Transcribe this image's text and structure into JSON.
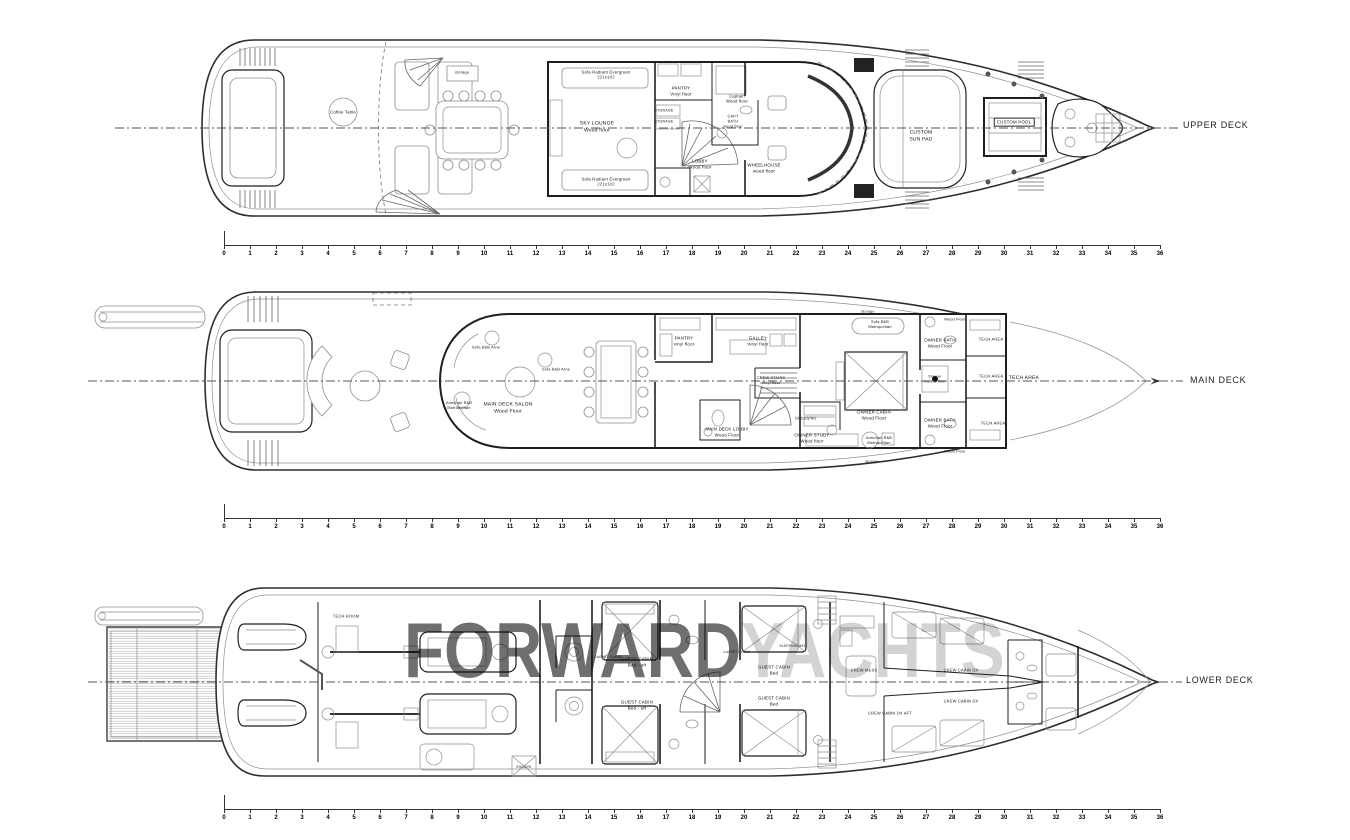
{
  "watermark": {
    "primary": "FORWARD",
    "secondary": "YACHTS"
  },
  "rulers": {
    "min": 0,
    "max": 36,
    "x": 224,
    "width": 936,
    "ys": [
      245,
      518,
      809
    ]
  },
  "decks": [
    {
      "name": "UPPER DECK",
      "label_x": 1183,
      "label_y": 125,
      "rooms": [
        {
          "t": "Coffee Table",
          "x": 343,
          "y": 112,
          "fs": 4.2
        },
        {
          "t": "storage",
          "x": 462,
          "y": 73,
          "fs": 3.8
        },
        {
          "t": "Sofa Radiant Evergreen\n221x102",
          "x": 606,
          "y": 75,
          "fs": 4.2
        },
        {
          "t": "SKY LOUNGE\nWood floor",
          "x": 597,
          "y": 127,
          "fs": 5
        },
        {
          "t": "Sofa Radiant Evergreen\n221x102",
          "x": 606,
          "y": 182,
          "fs": 4.2
        },
        {
          "t": "PANTRY\nVinyl floor",
          "x": 681,
          "y": 91,
          "fs": 4.4
        },
        {
          "t": "STORAGE",
          "x": 664,
          "y": 111,
          "fs": 3.6
        },
        {
          "t": "STORAGE",
          "x": 664,
          "y": 122,
          "fs": 3.6
        },
        {
          "t": "Captain\nWood floor",
          "x": 737,
          "y": 99,
          "fs": 4.2
        },
        {
          "t": "CAPT\nBATH\nwood floor",
          "x": 733,
          "y": 122,
          "fs": 3.8
        },
        {
          "t": "LOBBY\nWood floor",
          "x": 700,
          "y": 164,
          "fs": 4.4
        },
        {
          "t": "WHEELHOUSE\nwood floor",
          "x": 764,
          "y": 168,
          "fs": 4.4
        },
        {
          "t": "CUSTOM\nSUN PAD",
          "x": 921,
          "y": 136,
          "fs": 5
        },
        {
          "t": "CUSTOM POOL",
          "x": 1014,
          "y": 122,
          "fs": 4.4,
          "box": true
        }
      ]
    },
    {
      "name": "MAIN DECK",
      "label_x": 1190,
      "label_y": 380,
      "rooms": [
        {
          "t": "Armchair B&B\nMetropolitan",
          "x": 459,
          "y": 406,
          "fs": 3.8
        },
        {
          "t": "Sofa B&B Arne",
          "x": 486,
          "y": 348,
          "fs": 3.8
        },
        {
          "t": "Sofa B&B Arne",
          "x": 556,
          "y": 370,
          "fs": 3.8
        },
        {
          "t": "MAIN DECK SALON\nWood Floor",
          "x": 508,
          "y": 408,
          "fs": 5
        },
        {
          "t": "PANTRY\nvinyl floor",
          "x": 684,
          "y": 341,
          "fs": 4.4
        },
        {
          "t": "GALLEY\nVinyl floor",
          "x": 758,
          "y": 341,
          "fs": 4.4
        },
        {
          "t": "CREW STAIRS\nVinyl floor",
          "x": 771,
          "y": 381,
          "fs": 3.8
        },
        {
          "t": "MAIN DECK LOBBY\nWood Floor",
          "x": 727,
          "y": 432,
          "fs": 4.4
        },
        {
          "t": "DRESSING",
          "x": 806,
          "y": 419,
          "fs": 3.8
        },
        {
          "t": "OWNER STUDY\nWood floor",
          "x": 812,
          "y": 438,
          "fs": 4.4
        },
        {
          "t": "OWNER CABIN\nWood Floor",
          "x": 874,
          "y": 415,
          "fs": 4.4
        },
        {
          "t": "Sofa B&B\nMetropolitan",
          "x": 880,
          "y": 325,
          "fs": 3.8
        },
        {
          "t": "storage",
          "x": 868,
          "y": 312,
          "fs": 3.6
        },
        {
          "t": "storage",
          "x": 872,
          "y": 462,
          "fs": 3.6
        },
        {
          "t": "Armchair B&B\nMetropolitan",
          "x": 879,
          "y": 441,
          "fs": 3.8
        },
        {
          "t": "OWNER BATH\nWood Floor",
          "x": 940,
          "y": 343,
          "fs": 4.4
        },
        {
          "t": "OWNER BATH\nWood Floor",
          "x": 940,
          "y": 423,
          "fs": 4.4
        },
        {
          "t": "Shower\nmarble floor",
          "x": 935,
          "y": 379,
          "fs": 3.6
        },
        {
          "t": "Wood Floor",
          "x": 955,
          "y": 320,
          "fs": 3.8
        },
        {
          "t": "Wood Floor",
          "x": 955,
          "y": 452,
          "fs": 3.8
        },
        {
          "t": "TECH AREA",
          "x": 991,
          "y": 339,
          "fs": 4
        },
        {
          "t": "TECH AREA",
          "x": 991,
          "y": 376,
          "fs": 4
        },
        {
          "t": "TECH AREA",
          "x": 993,
          "y": 423,
          "fs": 4
        },
        {
          "t": "TECH AREA",
          "x": 1024,
          "y": 378,
          "fs": 5
        }
      ]
    },
    {
      "name": "LOWER DECK",
      "label_x": 1186,
      "label_y": 680,
      "rooms": [
        {
          "t": "TECH ROOM",
          "x": 346,
          "y": 616,
          "fs": 4
        },
        {
          "t": "ESCAPE",
          "x": 524,
          "y": 767,
          "fs": 3.4
        },
        {
          "t": "CARPET FLOOR",
          "x": 608,
          "y": 657,
          "fs": 3.2
        },
        {
          "t": "GUEST CABIN\nBed - aft",
          "x": 637,
          "y": 662,
          "fs": 4.4
        },
        {
          "t": "GUEST CABIN\nBed - aft",
          "x": 637,
          "y": 705,
          "fs": 4.4
        },
        {
          "t": "CARPET FLOOR",
          "x": 737,
          "y": 652,
          "fs": 3.2
        },
        {
          "t": "SLEEPING BED",
          "x": 793,
          "y": 646,
          "fs": 3.4
        },
        {
          "t": "GUEST CABIN\nBed",
          "x": 774,
          "y": 670,
          "fs": 4.4
        },
        {
          "t": "GUEST CABIN\nBed",
          "x": 774,
          "y": 701,
          "fs": 4.4
        },
        {
          "t": "CREW MESS",
          "x": 864,
          "y": 670,
          "fs": 4
        },
        {
          "t": "CREW CABIN DX",
          "x": 961,
          "y": 670,
          "fs": 4
        },
        {
          "t": "CREW CABIN DX",
          "x": 961,
          "y": 701,
          "fs": 4
        },
        {
          "t": "CREW CABIN DX AFT",
          "x": 890,
          "y": 713,
          "fs": 4
        }
      ]
    }
  ]
}
